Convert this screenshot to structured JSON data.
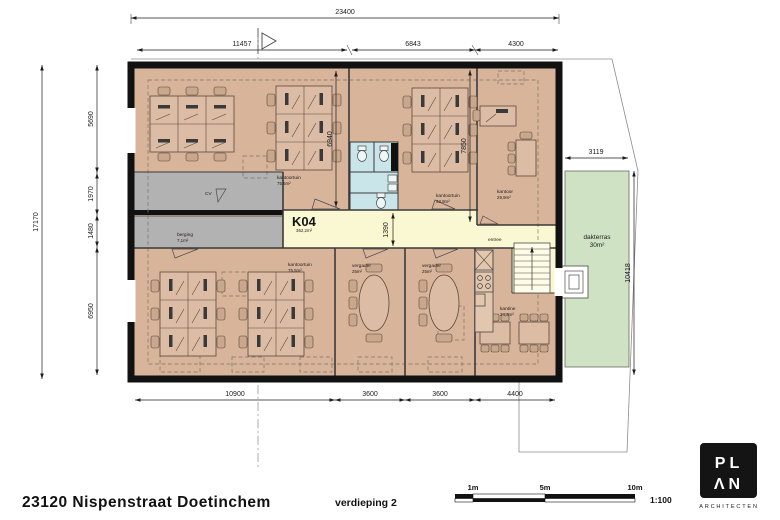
{
  "plan": {
    "rooms": {
      "kantoortuin_nw": {
        "name": "kantoortuin",
        "area": "75,5m²"
      },
      "kantoortuin_n": {
        "name": "kantoortuin",
        "area": "43,9m²"
      },
      "kantoor": {
        "name": "kantoor",
        "area": "29,9m²"
      },
      "cv": {
        "name": "CV"
      },
      "berging": {
        "name": "berging",
        "area": "7,1m²"
      },
      "corridor": {
        "code": "K04",
        "area": "362,2m²"
      },
      "entree": {
        "name": "entree"
      },
      "kantoortuin_sw": {
        "name": "kantoortuin",
        "area": "75,5m²"
      },
      "vergader_1": {
        "name": "vergader",
        "area": "25m²"
      },
      "vergader_2": {
        "name": "vergader",
        "area": "25m²"
      },
      "kantine": {
        "name": "kantine",
        "area": "24,3m²"
      },
      "dakterras": {
        "name": "dakterras",
        "area": "30m²"
      }
    },
    "dimensions": {
      "top_total": "23400",
      "top_segments": [
        "11457",
        "6843",
        "4300"
      ],
      "left_total": "17170",
      "left_segments": [
        "5690",
        "1970",
        "1480",
        "6950"
      ],
      "bottom_segments": [
        "10900",
        "3600",
        "3600",
        "4400"
      ],
      "interior": {
        "h_nw": "6940",
        "h_n": "7850",
        "corridor_width": "1390"
      },
      "right": {
        "terrace_width": "3119",
        "terrace_height": "10418"
      }
    }
  },
  "footer": {
    "project": "23120 Nispenstraat Doetinchem",
    "floor": "verdieping 2"
  },
  "scalebar": {
    "ticks": [
      "1m",
      "5m",
      "10m"
    ],
    "ratio": "1:100"
  },
  "logo": {
    "top": "PL",
    "bottom": "ΛN",
    "caption": "ARCHITECTEN"
  },
  "colors": {
    "room_fill": "#d8b49b",
    "corridor_fill": "#faf8d2",
    "wet_fill": "#c9e5e9",
    "storage_fill": "#b2b2b2",
    "terrace_fill": "#cfe2c4",
    "wall": "#111111"
  }
}
